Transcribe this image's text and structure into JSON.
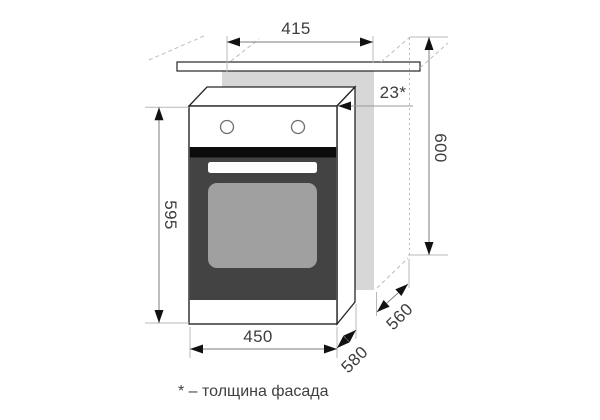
{
  "diagram": {
    "dimensions": {
      "niche_width_top": "415",
      "facade_thickness": "23*",
      "cabinet_height": "600",
      "oven_height": "595",
      "oven_width": "450",
      "oven_depth": "580",
      "niche_depth": "560"
    },
    "footnote": "* – толщина фасада",
    "colors": {
      "background": "#ffffff",
      "cabinet_panel_gray": "#d7d7d7",
      "oven_door_dark": "#434343",
      "door_gap_black": "#0c0c0c",
      "door_window_gray": "#a0a0a0",
      "outline": "#262626",
      "dimension_line": "#7d7d7d",
      "extension_line": "#b8b8b8",
      "label_text": "#3d3d3d"
    }
  }
}
